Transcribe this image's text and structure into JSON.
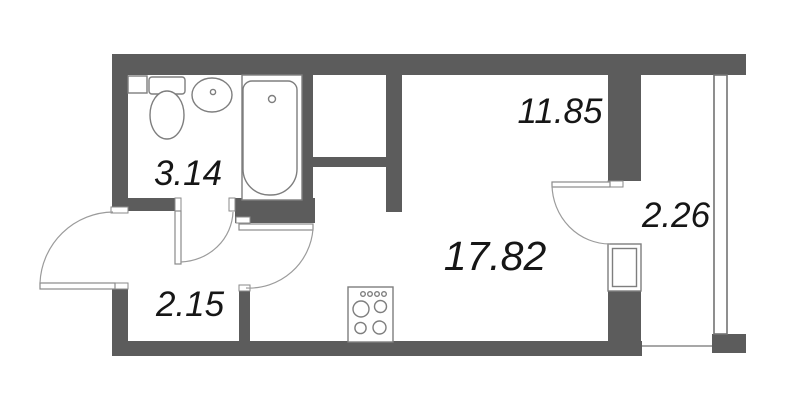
{
  "floor_plan": {
    "type": "studio-apartment-plan",
    "background_color": "#ffffff",
    "wall_color": "#5c5c5c",
    "outline_color": "#7e7e7e",
    "label_color": "#161616",
    "rooms": [
      {
        "name": "bathroom",
        "area_label": "3.14"
      },
      {
        "name": "hallway",
        "area_label": "2.15"
      },
      {
        "name": "living-kitchen",
        "area_label": "17.82"
      },
      {
        "name": "room-zone",
        "area_label": "11.85"
      },
      {
        "name": "balcony",
        "area_label": "2.26"
      }
    ],
    "fixtures": [
      "toilet",
      "washbasin",
      "shelf",
      "bathtub",
      "cooktop",
      "entrance-door",
      "bathroom-door",
      "room-door",
      "balcony-door",
      "balcony-window",
      "balcony-glazing",
      "ventilation-shaft"
    ]
  }
}
